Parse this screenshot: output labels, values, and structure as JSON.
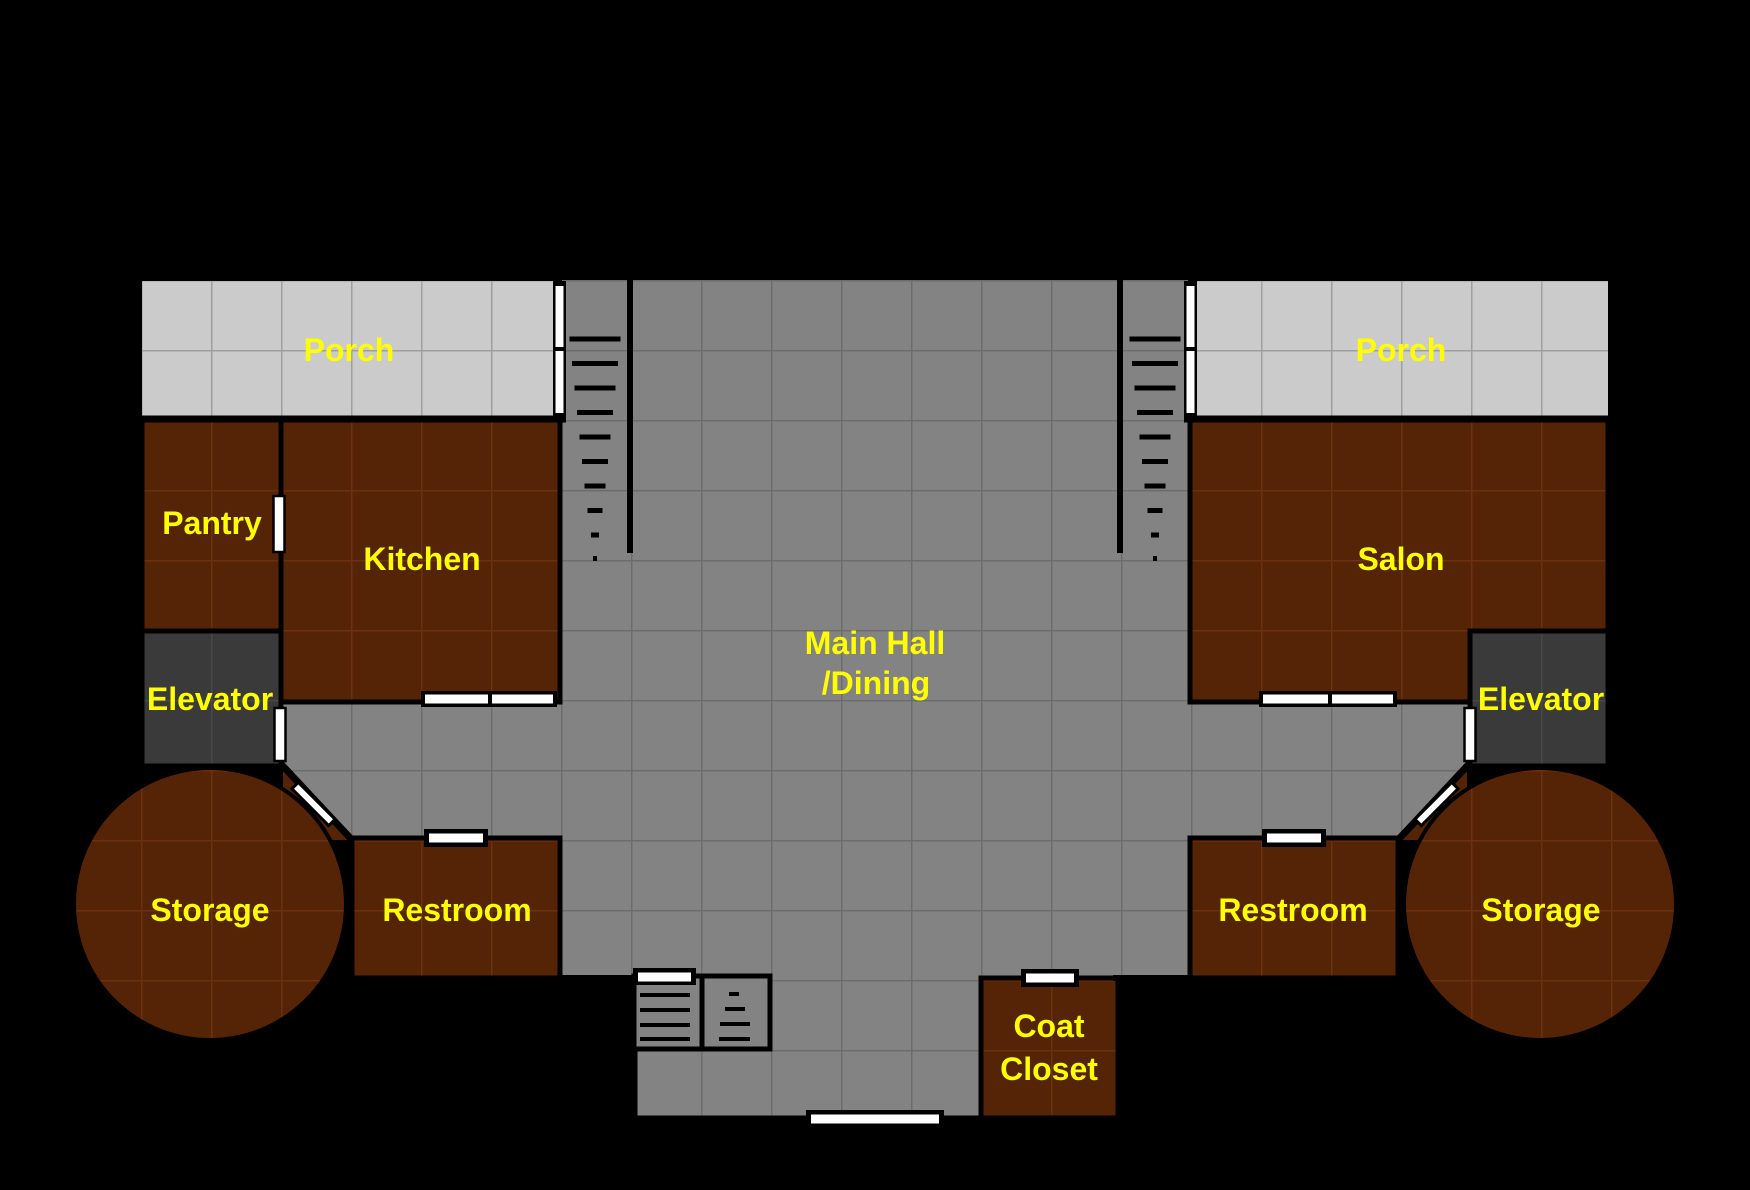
{
  "canvas": {
    "width": 1750,
    "height": 1190,
    "background": "#000000"
  },
  "palette": {
    "hall_fill": "#838383",
    "hall_grid": "#6c6c6c",
    "porch_fill": "#cbcbcb",
    "porch_grid": "#9f9f9f",
    "room_fill": "#552306",
    "room_grid": "#6b3110",
    "elevator_fill": "#3a3a3a",
    "elevator_grid": "#484848",
    "wall_color": "#000000",
    "door_color": "#ffffff",
    "label_color": "#ffff00"
  },
  "labels": {
    "porch_left": "Porch",
    "porch_right": "Porch",
    "pantry": "Pantry",
    "kitchen": "Kitchen",
    "salon": "Salon",
    "elevator_left": "Elevator",
    "elevator_right": "Elevator",
    "main_hall_line1": "Main Hall",
    "main_hall_line2": "/Dining",
    "storage_left": "Storage",
    "storage_right": "Storage",
    "restroom_left": "Restroom",
    "restroom_right": "Restroom",
    "coat_closet_line1": "Coat",
    "coat_closet_line2": "Closet"
  }
}
